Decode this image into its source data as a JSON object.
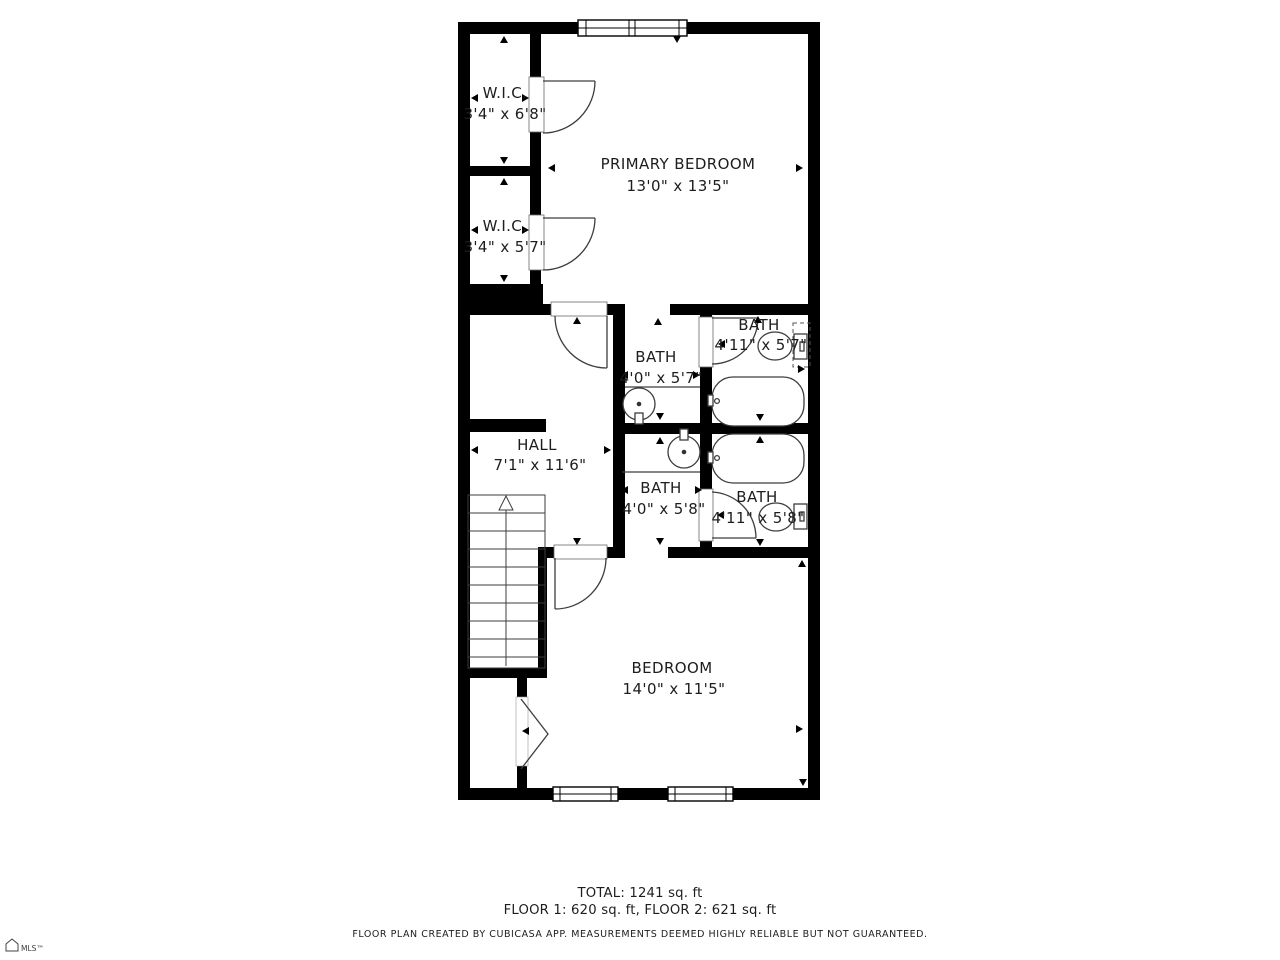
{
  "plan": {
    "rooms": [
      {
        "name": "W.I.C.",
        "dims": "3'4\" x 6'8\""
      },
      {
        "name": "W.I.C.",
        "dims": "3'4\" x 5'7\""
      },
      {
        "name": "PRIMARY BEDROOM",
        "dims": "13'0\" x 13'5\""
      },
      {
        "name": "BATH",
        "dims": "4'0\" x 5'7\""
      },
      {
        "name": "BATH",
        "dims": "4'11\" x 5'7\""
      },
      {
        "name": "HALL",
        "dims": "7'1\" x 11'6\""
      },
      {
        "name": "BATH",
        "dims": "4'0\" x 5'8\""
      },
      {
        "name": "BATH",
        "dims": "4'11\" x 5'8\""
      },
      {
        "name": "BEDROOM",
        "dims": "14'0\" x 11'5\""
      }
    ],
    "summary": {
      "total": "TOTAL: 1241 sq. ft",
      "floors": "FLOOR 1: 620 sq. ft, FLOOR 2: 621 sq. ft"
    },
    "disclaimer": "FLOOR PLAN CREATED BY CUBICASA APP. MEASUREMENTS DEEMED HIGHLY RELIABLE BUT NOT GUARANTEED.",
    "watermark": "MLS™",
    "colors": {
      "wall": "#000000",
      "line": "#3d3d3d",
      "text": "#1d1d1d"
    }
  }
}
